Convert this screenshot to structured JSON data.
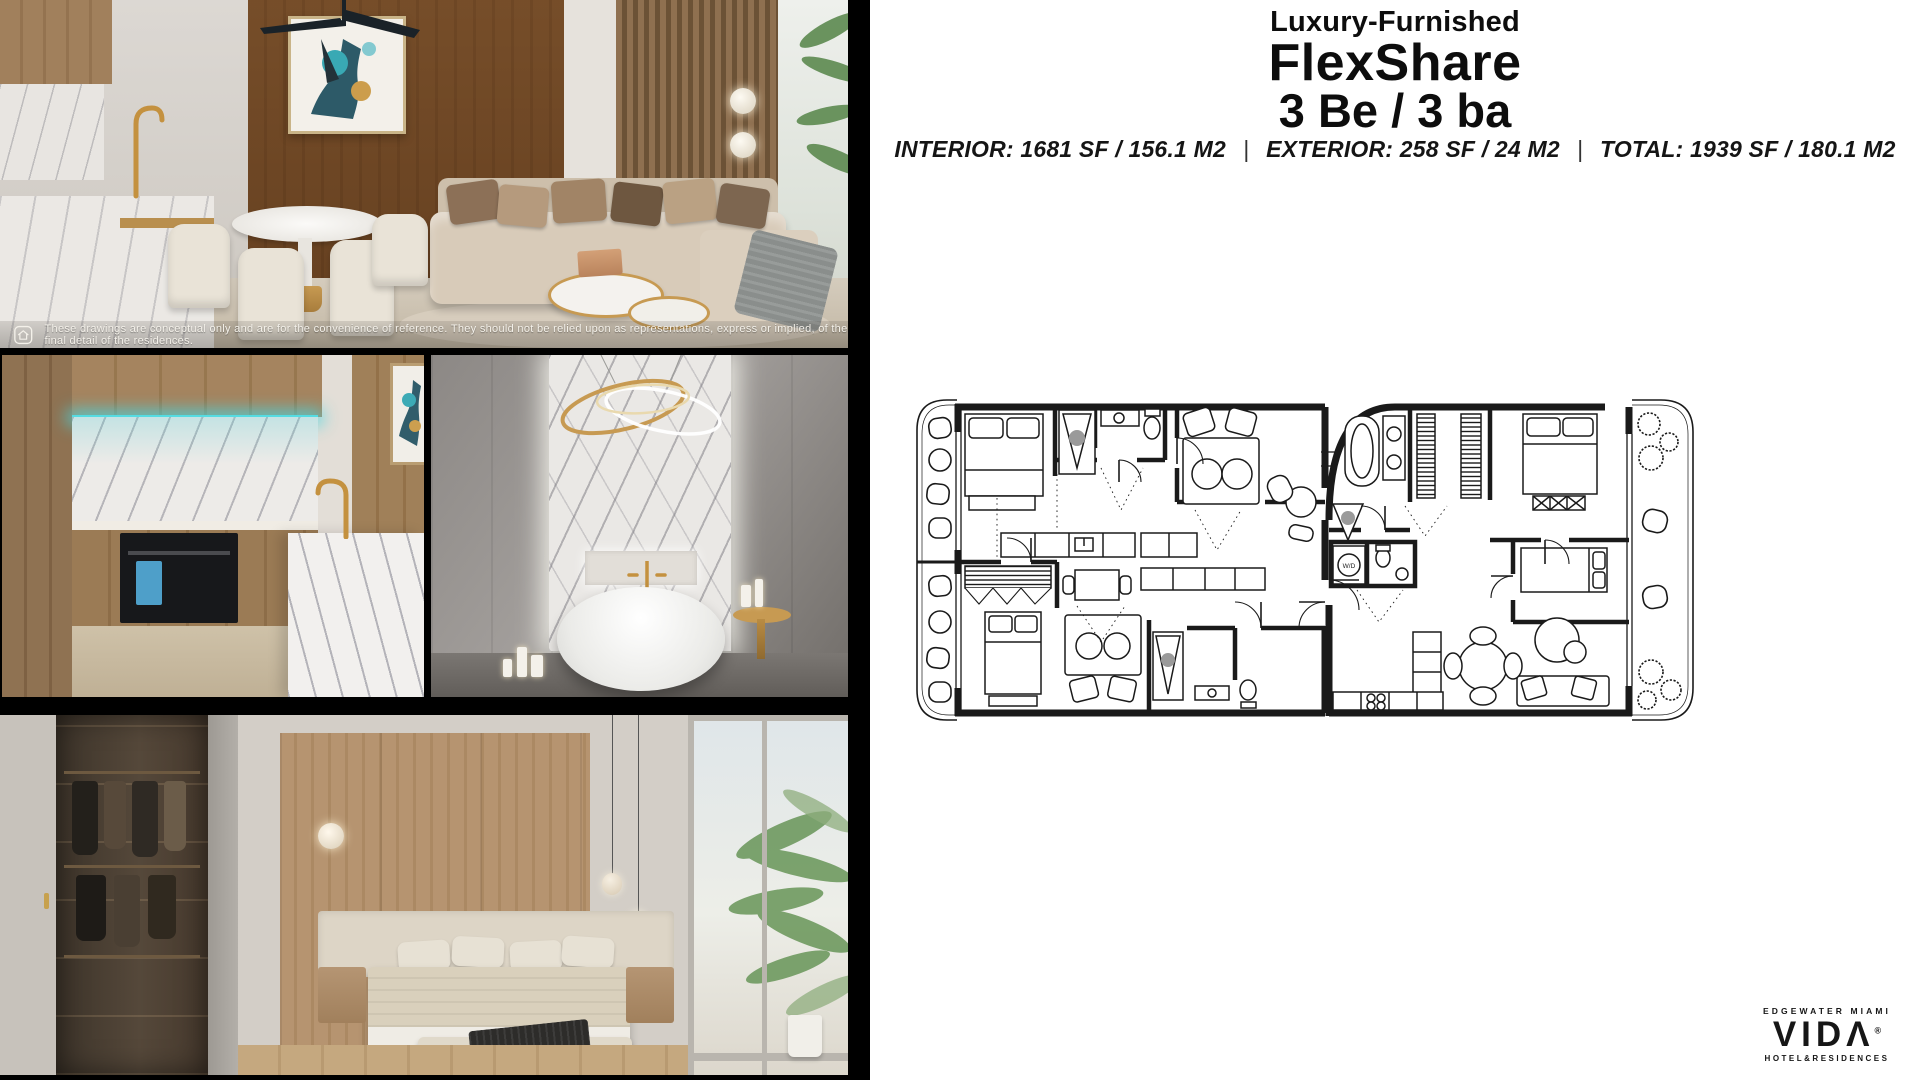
{
  "header": {
    "subtitle": "Luxury-Furnished",
    "title": "FlexShare",
    "bedbath": "3 Be / 3 ba",
    "specs": {
      "interior": "INTERIOR: 1681 SF / 156.1 M2",
      "sep1": "|",
      "exterior": "EXTERIOR: 258 SF / 24 M2",
      "sep2": "|",
      "total": "TOTAL: 1939 SF / 180.1 M2"
    }
  },
  "collage": {
    "disclaimer": "These drawings are conceptual only and are for the convenience of reference. They should not be relied upon as representations, express or implied, of the final detail of the residences.",
    "photos": [
      {
        "name": "living-room-render"
      },
      {
        "name": "kitchen-render"
      },
      {
        "name": "bathroom-render"
      },
      {
        "name": "bedroom-closet-render"
      }
    ]
  },
  "floorplan": {
    "wd_label": "W/D"
  },
  "logo": {
    "location": "EDGEWATER MIAMI",
    "brand": "VIDΛ",
    "registered": "®",
    "tagline": "HOTEL&RESIDENCES"
  },
  "colors": {
    "collage_background": "#000000",
    "panel_background": "#ffffff",
    "text": "#0d0d0d",
    "plan_lines": "#1a1a1a",
    "led_teal": "#55dce2",
    "gold_accent": "#c79a52",
    "wood_tone": "#a88762",
    "marble_tone": "#eceae7"
  }
}
